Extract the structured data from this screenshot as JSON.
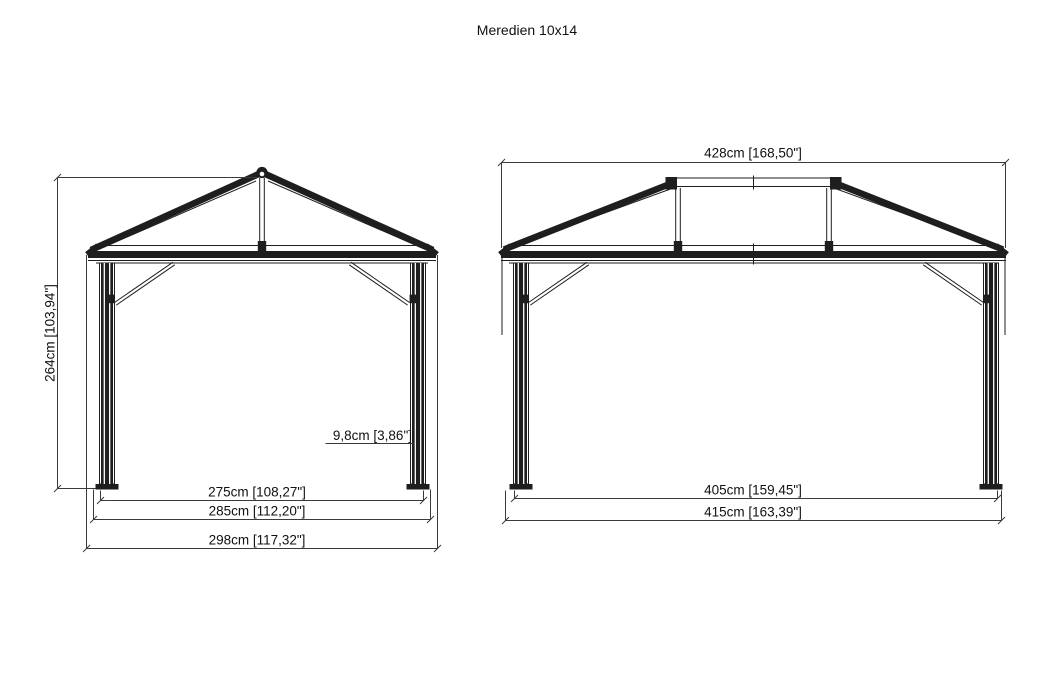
{
  "title": "Meredien 10x14",
  "front_view": {
    "label": "front-gable-elevation",
    "height_dim": "264cm [103,94\"]",
    "post_width_dim": "9,8cm [3,86\"]",
    "inner_width_dim": "275cm [108,27\"]",
    "mid_width_dim": "285cm [112,20\"]",
    "outer_width_dim": "298cm [117,32\"]"
  },
  "side_view": {
    "label": "side-elevation",
    "roof_width_dim": "428cm [168,50\"]",
    "inner_width_dim": "405cm [159,45\"]",
    "outer_width_dim": "415cm [163,39\"]"
  },
  "colors": {
    "ink": "#1e1e1e",
    "dim_line": "#3a3a3a",
    "background": "#ffffff"
  }
}
